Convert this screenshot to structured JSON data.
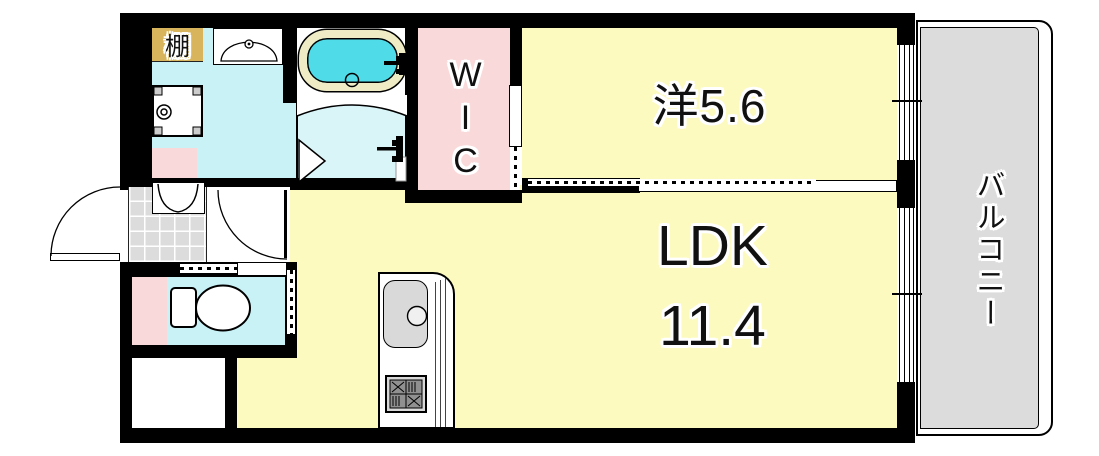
{
  "plan_title": "1LDK floor plan",
  "rooms": {
    "western": {
      "label": "洋5.6"
    },
    "ldk": {
      "label": "LDK",
      "size": "11.4"
    },
    "wic": {
      "label": "WIC"
    },
    "balcony": {
      "label": "バルコニー"
    },
    "shelf": {
      "label": "棚"
    }
  },
  "fixtures": [
    "bathtub",
    "bath-folding-door",
    "shower-mixer",
    "washbasin",
    "washing-machine-pan",
    "shoe-cabinet",
    "entrance-door",
    "interior-door",
    "toilet",
    "kitchen-sink",
    "gas-stove",
    "sliding-door",
    "window"
  ],
  "colors": {
    "room_yellow": "#FCFABE",
    "floor_cyan": "#C9F2F7",
    "bath_cyan": "#DAF5F8",
    "tub_water": "#4FDBE8",
    "tub_rim": "#EFECC5",
    "pink": "#FAD9DA",
    "shelf_tan": "#D8B55C",
    "balcony_gray": "#DCDCDC",
    "tile_gray": "#DCDCDC",
    "wall": "#000000",
    "sink_gray": "#D9D9D9"
  }
}
